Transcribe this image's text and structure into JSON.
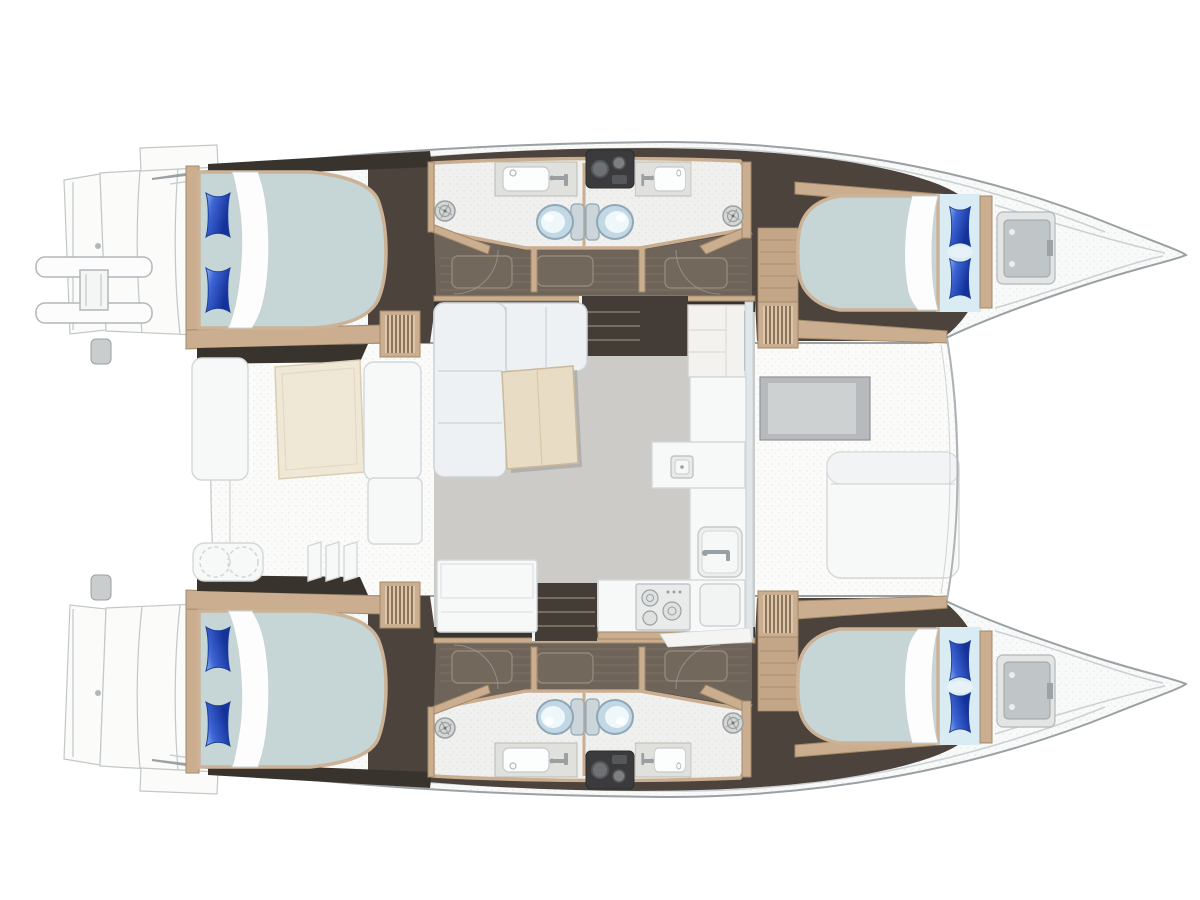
{
  "meta": {
    "description": "Top-down interior deck plan of a sailing catamaran, bow pointing right, no text labels rendered",
    "style": "rendered yacht floor plan illustration"
  },
  "colors": {
    "page_bg": "#ffffff",
    "hull_fill": "#f8f9f9",
    "hull_stroke": "#9aa0a3",
    "hull_inner_line": "#cbd0d1",
    "deck": "#fbfbfa",
    "deck_stroke": "#c2c7c8",
    "wenge": "#4b433c",
    "wenge_dark": "#39332d",
    "corridor": "#6f6459",
    "corridor_line": "#807567",
    "teak": "#c3a587",
    "wood": "#cbae90",
    "wood_stroke": "#a28a68",
    "bath_floor": "#f0f1ef",
    "mattress": "#c6d6d7",
    "mattress_edge": "#ccb296",
    "sheet": "#d9ecf4",
    "fold_white": "#fdfdfe",
    "salon_floor": "#cccbc7",
    "sofa": "#eef1f4",
    "sofa_stroke": "#ccd2d6",
    "table_wood": "#e9dcc4",
    "table_stroke": "#ccb99b",
    "counter": "#f7f8f8",
    "counter_stroke": "#d4d7d8",
    "appliance": "#e9ebeb",
    "cream": "#f0e8d7",
    "cream_stroke": "#dacdb2",
    "fixture_gray": "#9aa0a2",
    "dark_hw": "#3b3b3d",
    "step_dark": "#443c36",
    "step_edge": "#8a7d6e",
    "glass": "#dfe7ea",
    "window_gray": "#b6babc",
    "window_inner": "#cdd1d2",
    "hatch_outer": "#e3e5e5",
    "hatch_inner": "#c0c5c7",
    "toilet_ring": "#8fa6b4",
    "toilet_bowl": "#c2d8e4",
    "toilet_inner": "#eef8fb",
    "pillow_hi": "#8fb2f0",
    "pillow_mid": "#3e66d6",
    "pillow_lo": "#14329a",
    "speckle": "#8a9093"
  },
  "inventory": {
    "hulls": 2,
    "double_berth_cabins": 4,
    "bathrooms": 4,
    "toilets": 4,
    "bathroom_sinks": 4,
    "shower_drains": 4,
    "pillows": 8,
    "companionway_steps": 4,
    "salon_sofa_sections": 2,
    "salon_tables": 1,
    "galley_sinks": 2,
    "galley_stoves": 1,
    "refrigerators": 1,
    "cockpit_benches": 2,
    "cockpit_tables": 1,
    "helm_seats": 1,
    "bow_hatches": 2,
    "boarding_ladders": 1,
    "transom_platforms": 2
  },
  "regions": [
    "port-hull",
    "starboard-hull",
    "aft-cockpit",
    "salon",
    "galley",
    "forward-cockpit",
    "bow-lockers"
  ]
}
